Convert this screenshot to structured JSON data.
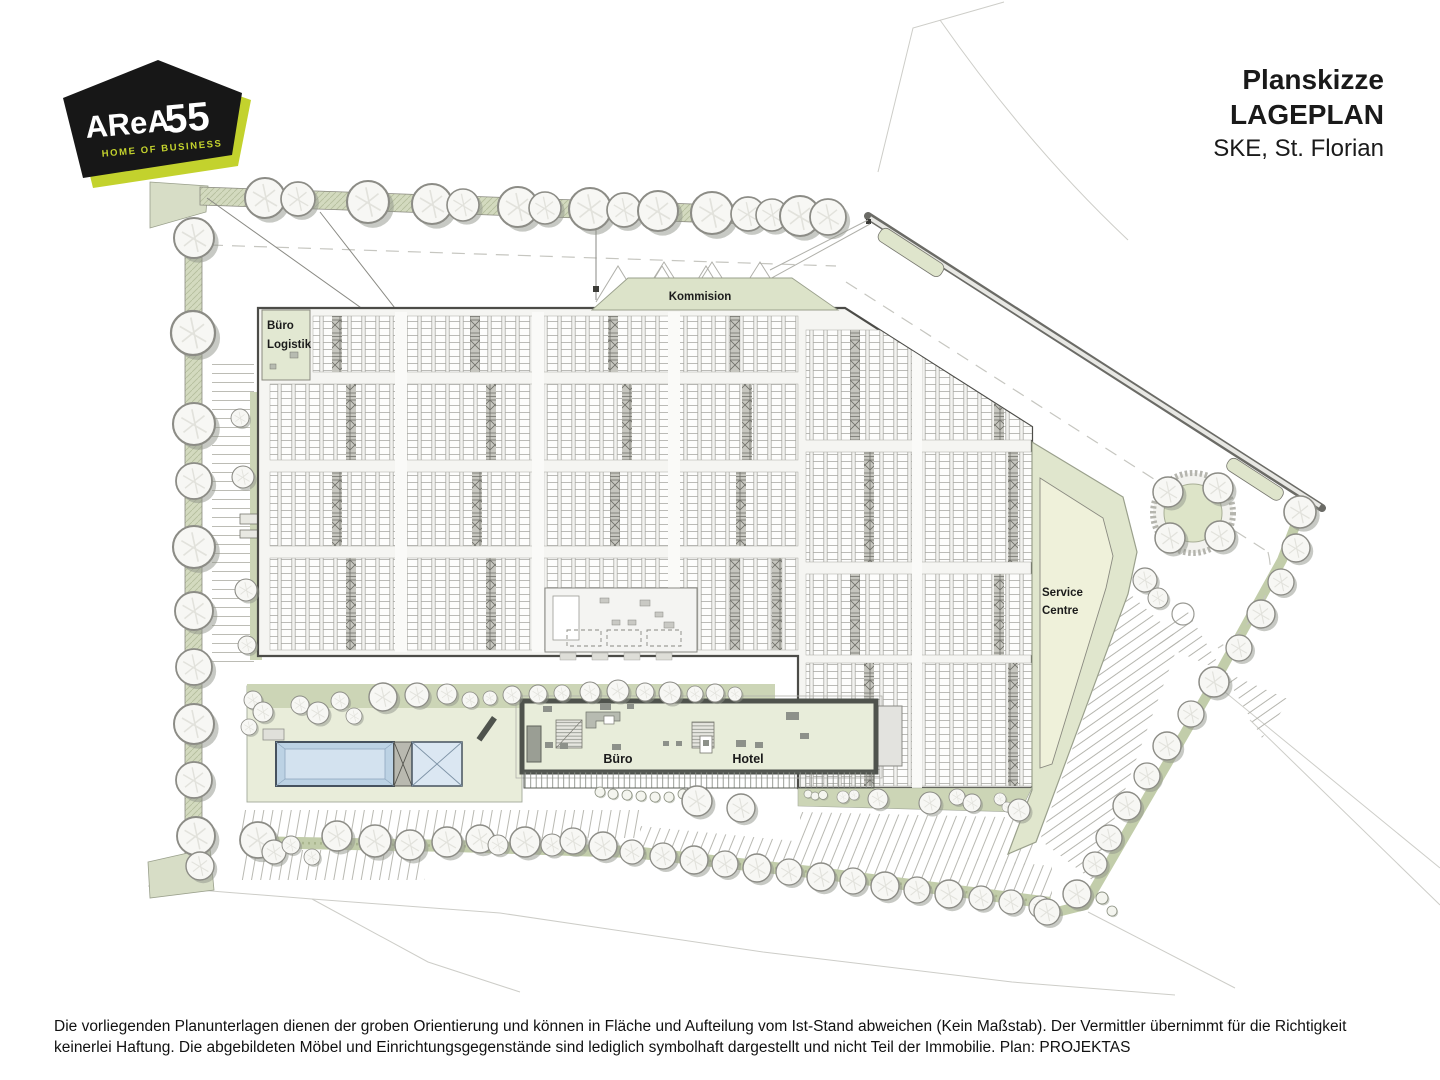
{
  "logo": {
    "brand_main": "AReA",
    "brand_suffix": "55",
    "tagline": "HOME OF BUSINESS"
  },
  "title_block": {
    "line1": "Planskizze",
    "line2": "LAGEPLAN",
    "line3": "SKE, St. Florian"
  },
  "plan": {
    "labels": {
      "buero_logistik_line1": "Büro",
      "buero_logistik_line2": "Logistik",
      "kommision": "Kommision",
      "service_centre_line1": "Service",
      "service_centre_line2": "Centre",
      "buero": "Büro",
      "hotel": "Hotel"
    }
  },
  "footer": {
    "disclaimer": "Die vorliegenden Planunterlagen dienen der groben Orientierung und können in Fläche und Aufteilung vom Ist-Stand abweichen (Kein Maßstab). Der Vermittler übernimmt für die Richtigkeit keinerlei Haftung. Die abgebildeten Möbel und Einrichtungsgegenstände sind lediglich symbolhaft dargestellt und nicht Teil der Immobilie. Plan: PROJEKTAS"
  },
  "colors": {
    "brand_lime": "#c3d22d",
    "brand_black": "#171717",
    "plan_green": "#d7ddc6",
    "plan_green_dark": "#ccd5b6",
    "service_yellow": "#eff1da",
    "pool_blue": "#bcd2e4"
  }
}
